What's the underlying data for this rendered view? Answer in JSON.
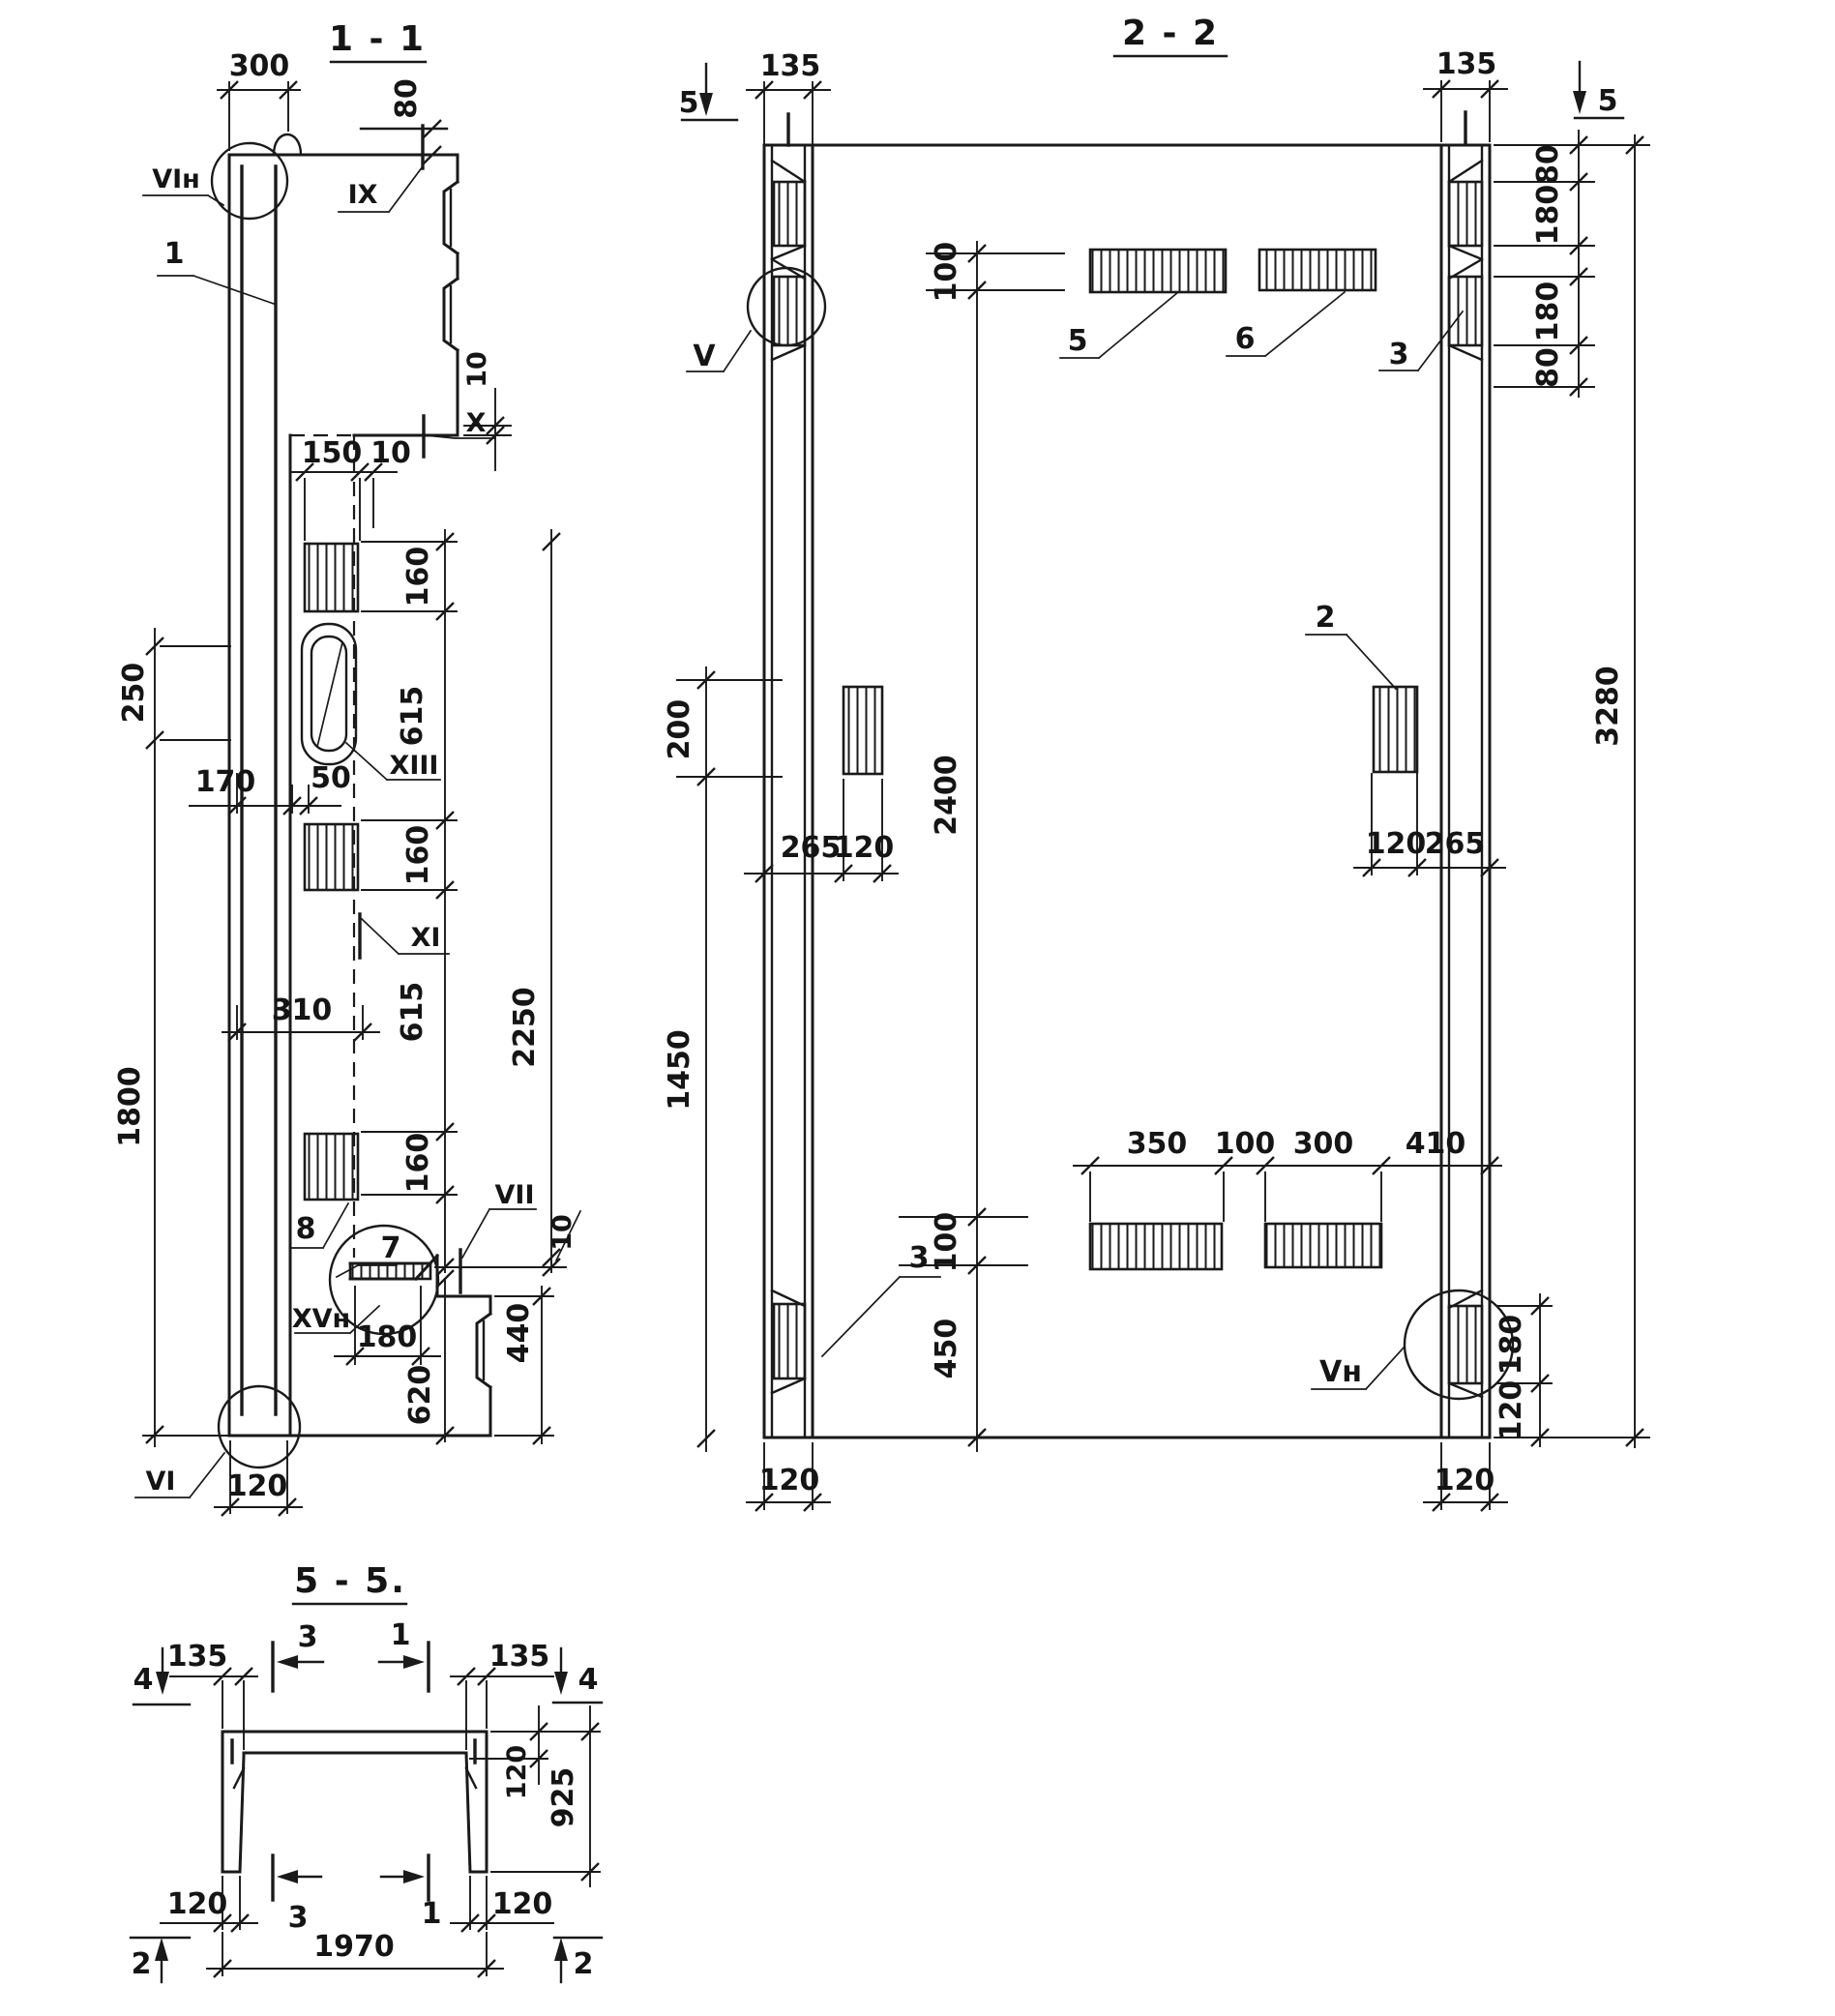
{
  "meta": {
    "background": "#ffffff",
    "ink": "#1a1a1a",
    "drawing_type": "reinforced-concrete panel shop drawing"
  },
  "s11": {
    "title": "1 - 1",
    "labels": {
      "vi_n": "VIн",
      "ix": "IX",
      "x": "X",
      "xiii": "XIII",
      "xi": "XI",
      "vii": "VII",
      "xv_n": "XVн",
      "vi": "VI"
    },
    "callouts": {
      "c1": "1",
      "c7": "7",
      "c8": "8"
    },
    "dims": {
      "top_width": "300",
      "top_offset": "80",
      "step_top": "10",
      "plate_w": "150",
      "gap": "10",
      "seg160a": "160",
      "seg615a": "615",
      "seg160b": "160",
      "seg615b": "615",
      "seg160c": "160",
      "total": "2250",
      "left250": "250",
      "left1800": "1800",
      "off170": "170",
      "off50": "50",
      "off310": "310",
      "ledge180": "180",
      "ledge620": "620",
      "flange440": "440",
      "step10": "10",
      "wall120": "120"
    }
  },
  "s22": {
    "title": "2 - 2",
    "section_markers": {
      "m5l": "5",
      "m5r": "5"
    },
    "labels": {
      "v": "V",
      "v_n": "Vн"
    },
    "callouts": {
      "c5": "5",
      "c6": "6",
      "c3a": "3",
      "c2": "2",
      "c3b": "3"
    },
    "dims": {
      "col135l": "135",
      "col135r": "135",
      "top100": "100",
      "r80a": "80",
      "r180a": "180",
      "r180b": "180",
      "r80b": "80",
      "total3280": "3280",
      "left200": "200",
      "mid2400": "2400",
      "l265": "265",
      "l120": "120",
      "r120": "120",
      "r265": "265",
      "left1450": "1450",
      "low100": "100",
      "low450": "450",
      "b350": "350",
      "b100": "100",
      "b300": "300",
      "b410": "410",
      "rl180": "180",
      "rl120": "120",
      "foot120l": "120",
      "foot120r": "120"
    }
  },
  "s55": {
    "title": "5 - 5.",
    "section_markers": {
      "m4l": "4",
      "m4r": "4",
      "m2l": "2",
      "m2r": "2",
      "a3t": "3",
      "a1t": "1",
      "a3b": "3",
      "a1b": "1"
    },
    "dims": {
      "l135": "135",
      "r135": "135",
      "slab120": "120",
      "h925": "925",
      "f120l": "120",
      "f120r": "120",
      "w1970": "1970"
    }
  }
}
